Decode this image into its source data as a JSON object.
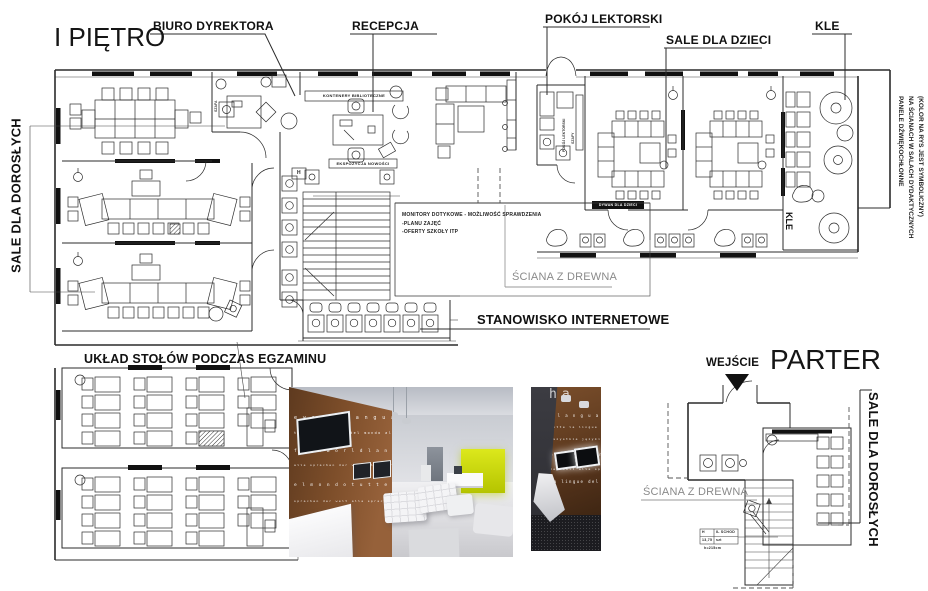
{
  "colors": {
    "leader_black": "#2b2b2b",
    "leader_gray": "#999999",
    "accent_green": "#c6d500"
  },
  "drawing": {
    "first_floor": {
      "title": "I PIĘTRO",
      "callout_biuro": "BIURO DYREKTORA",
      "callout_recepcja": "RECEPCJA",
      "callout_pokoj": "POKÓJ LEKTORSKI",
      "callout_dzieci": "SALE DLA DZIECI",
      "callout_kle": "KLE",
      "callout_dorosli": "SALE DLA DOROSŁYCH",
      "callout_sciana": "ŚCIANA Z DREWNA",
      "callout_internet": "STANOWISKO INTERNETOWE",
      "acoustic_line1": "PANELE DŹWIĘKOCHŁONNE",
      "acoustic_line2": "NA ŚCIANACH W SALACH DYDAKTYCZNYCH",
      "acoustic_line3": "(KOLOR NA RYS JEST SYMBOLICZNY)",
      "monitors_line1": "MONITORY DOTYKOWE - MOŻLIWOŚĆ SPRAWDZENIA",
      "monitors_line2": "-PLANU ZAJĘĆ",
      "monitors_line3": "-OFERTY SZKOŁY ITP",
      "micro_kontenery": "KONTENERY BIBLIOTECZNE",
      "micro_ekspozycja": "EKSPOZYCJA NOWOŚCI",
      "micro_dywan": "DYWAN DLA DZIECI",
      "micro_kle_wall": "KLE",
      "micro_pokoj": "POKÓJ LEKTORSKI",
      "micro_szafy": "SZAFY",
      "micro_szafa": "SZAFA",
      "micro_hydrant": "H"
    },
    "exam": {
      "title": "UKŁAD STOŁÓW PODCZAS EGZAMINU"
    },
    "parter": {
      "title": "PARTER",
      "callout_wejscie": "WEJŚCIE",
      "callout_dorosli": "SALE DLA DOROSŁYCH",
      "callout_sciana": "ŚCIANA Z DREWNA",
      "legend_r1c1": "H",
      "legend_r1c2": "IL SCHOD",
      "legend_r2c1": "13,75",
      "legend_r2c2": "szt",
      "legend_note": "h=215cm"
    },
    "photos": {
      "photo1": {
        "lines": [
          "e  w o r l d   l a n g u a g e s   o f   t h e   w",
          "tutte la lingua del mondo  alle sprachen",
          "f  t h e   w o r l d   l a n g u a g e s   of  the  world",
          "alle  sprachen  der  welt  alle  sprachen  der  welt",
          "e l   m o n d o   t u t t e   l a   l i n g u e   d e l",
          "sprachen der welt alle sprachen der welt alle"
        ]
      },
      "photo2": {
        "lines": [
          "d  l a n g u a g e s   o f   t h e",
          "tutte la lingue del mondo",
          "wszystkie języki świata wszystk",
          "o r l d   l a n g u a g e s   o f",
          "der welt alle sprachen der welt",
          "la  lingue  del  mondo  tu"
        ]
      }
    }
  }
}
